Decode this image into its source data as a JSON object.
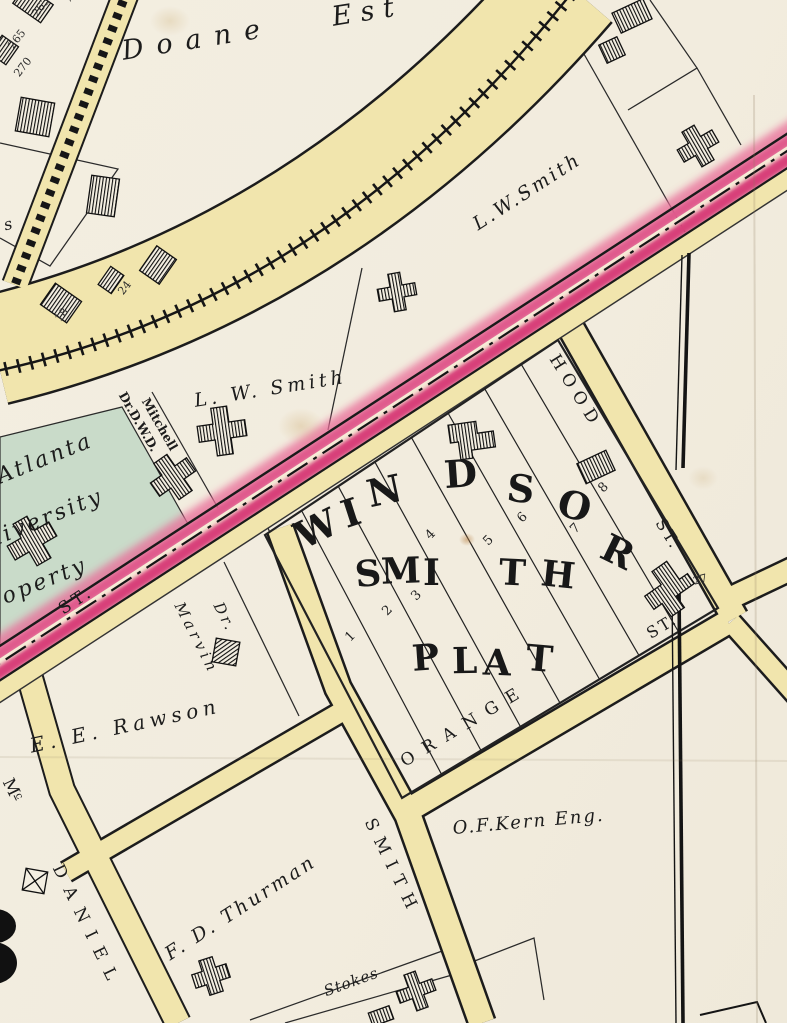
{
  "map_type": "historic-plat-map",
  "colors": {
    "paper": "#f2ecdf",
    "street_yellow": "#f1e5ad",
    "road_pink": "#d84079",
    "road_pink_light": "#e05a8c",
    "parcel_green": "#c9dbc9",
    "ink": "#1b1b1b"
  },
  "owners": {
    "doane": "Doane",
    "doane_est": "Est",
    "lw_smith_top": "L.W.Smith",
    "lw_smith_mid": "L. W. Smith",
    "rawson": "E. E. Rawson",
    "marvin_dr": "Dr.",
    "marvin": "Marvin",
    "mitchell_line1": "Mitchell",
    "mitchell_line2": "Dr.D.W.D.",
    "atlanta_1": "Atlanta",
    "atlanta_2": "University",
    "atlanta_3": "Property",
    "kern": "O.F.Kern Eng.",
    "thurman": "F. D. Thurman",
    "stokes": "Stokes",
    "s_fragment": "s"
  },
  "streets": {
    "hood": "HOOD",
    "hood_st": "ST.",
    "orange": "ORANGE",
    "orange_st": "ST.",
    "smith": "SMITH",
    "mcdaniel_m": "M",
    "mcdaniel_c": "c",
    "mcdaniel": "DANIEL",
    "st_road": "ST."
  },
  "plat": {
    "windsor": [
      "W",
      "I",
      "N",
      "D",
      "S",
      "O",
      "R"
    ],
    "smith": [
      "S",
      "M",
      "I",
      "T",
      "H"
    ],
    "plat_word": [
      "P",
      "L",
      "A",
      "T"
    ],
    "lots": [
      "1",
      "2",
      "3",
      "4",
      "5",
      "6",
      "7",
      "8"
    ]
  },
  "numbers": {
    "n7": "7",
    "n263": "263",
    "n265": "265",
    "n270": "270",
    "n24": "24",
    "n18": "18",
    "n27": "27"
  }
}
